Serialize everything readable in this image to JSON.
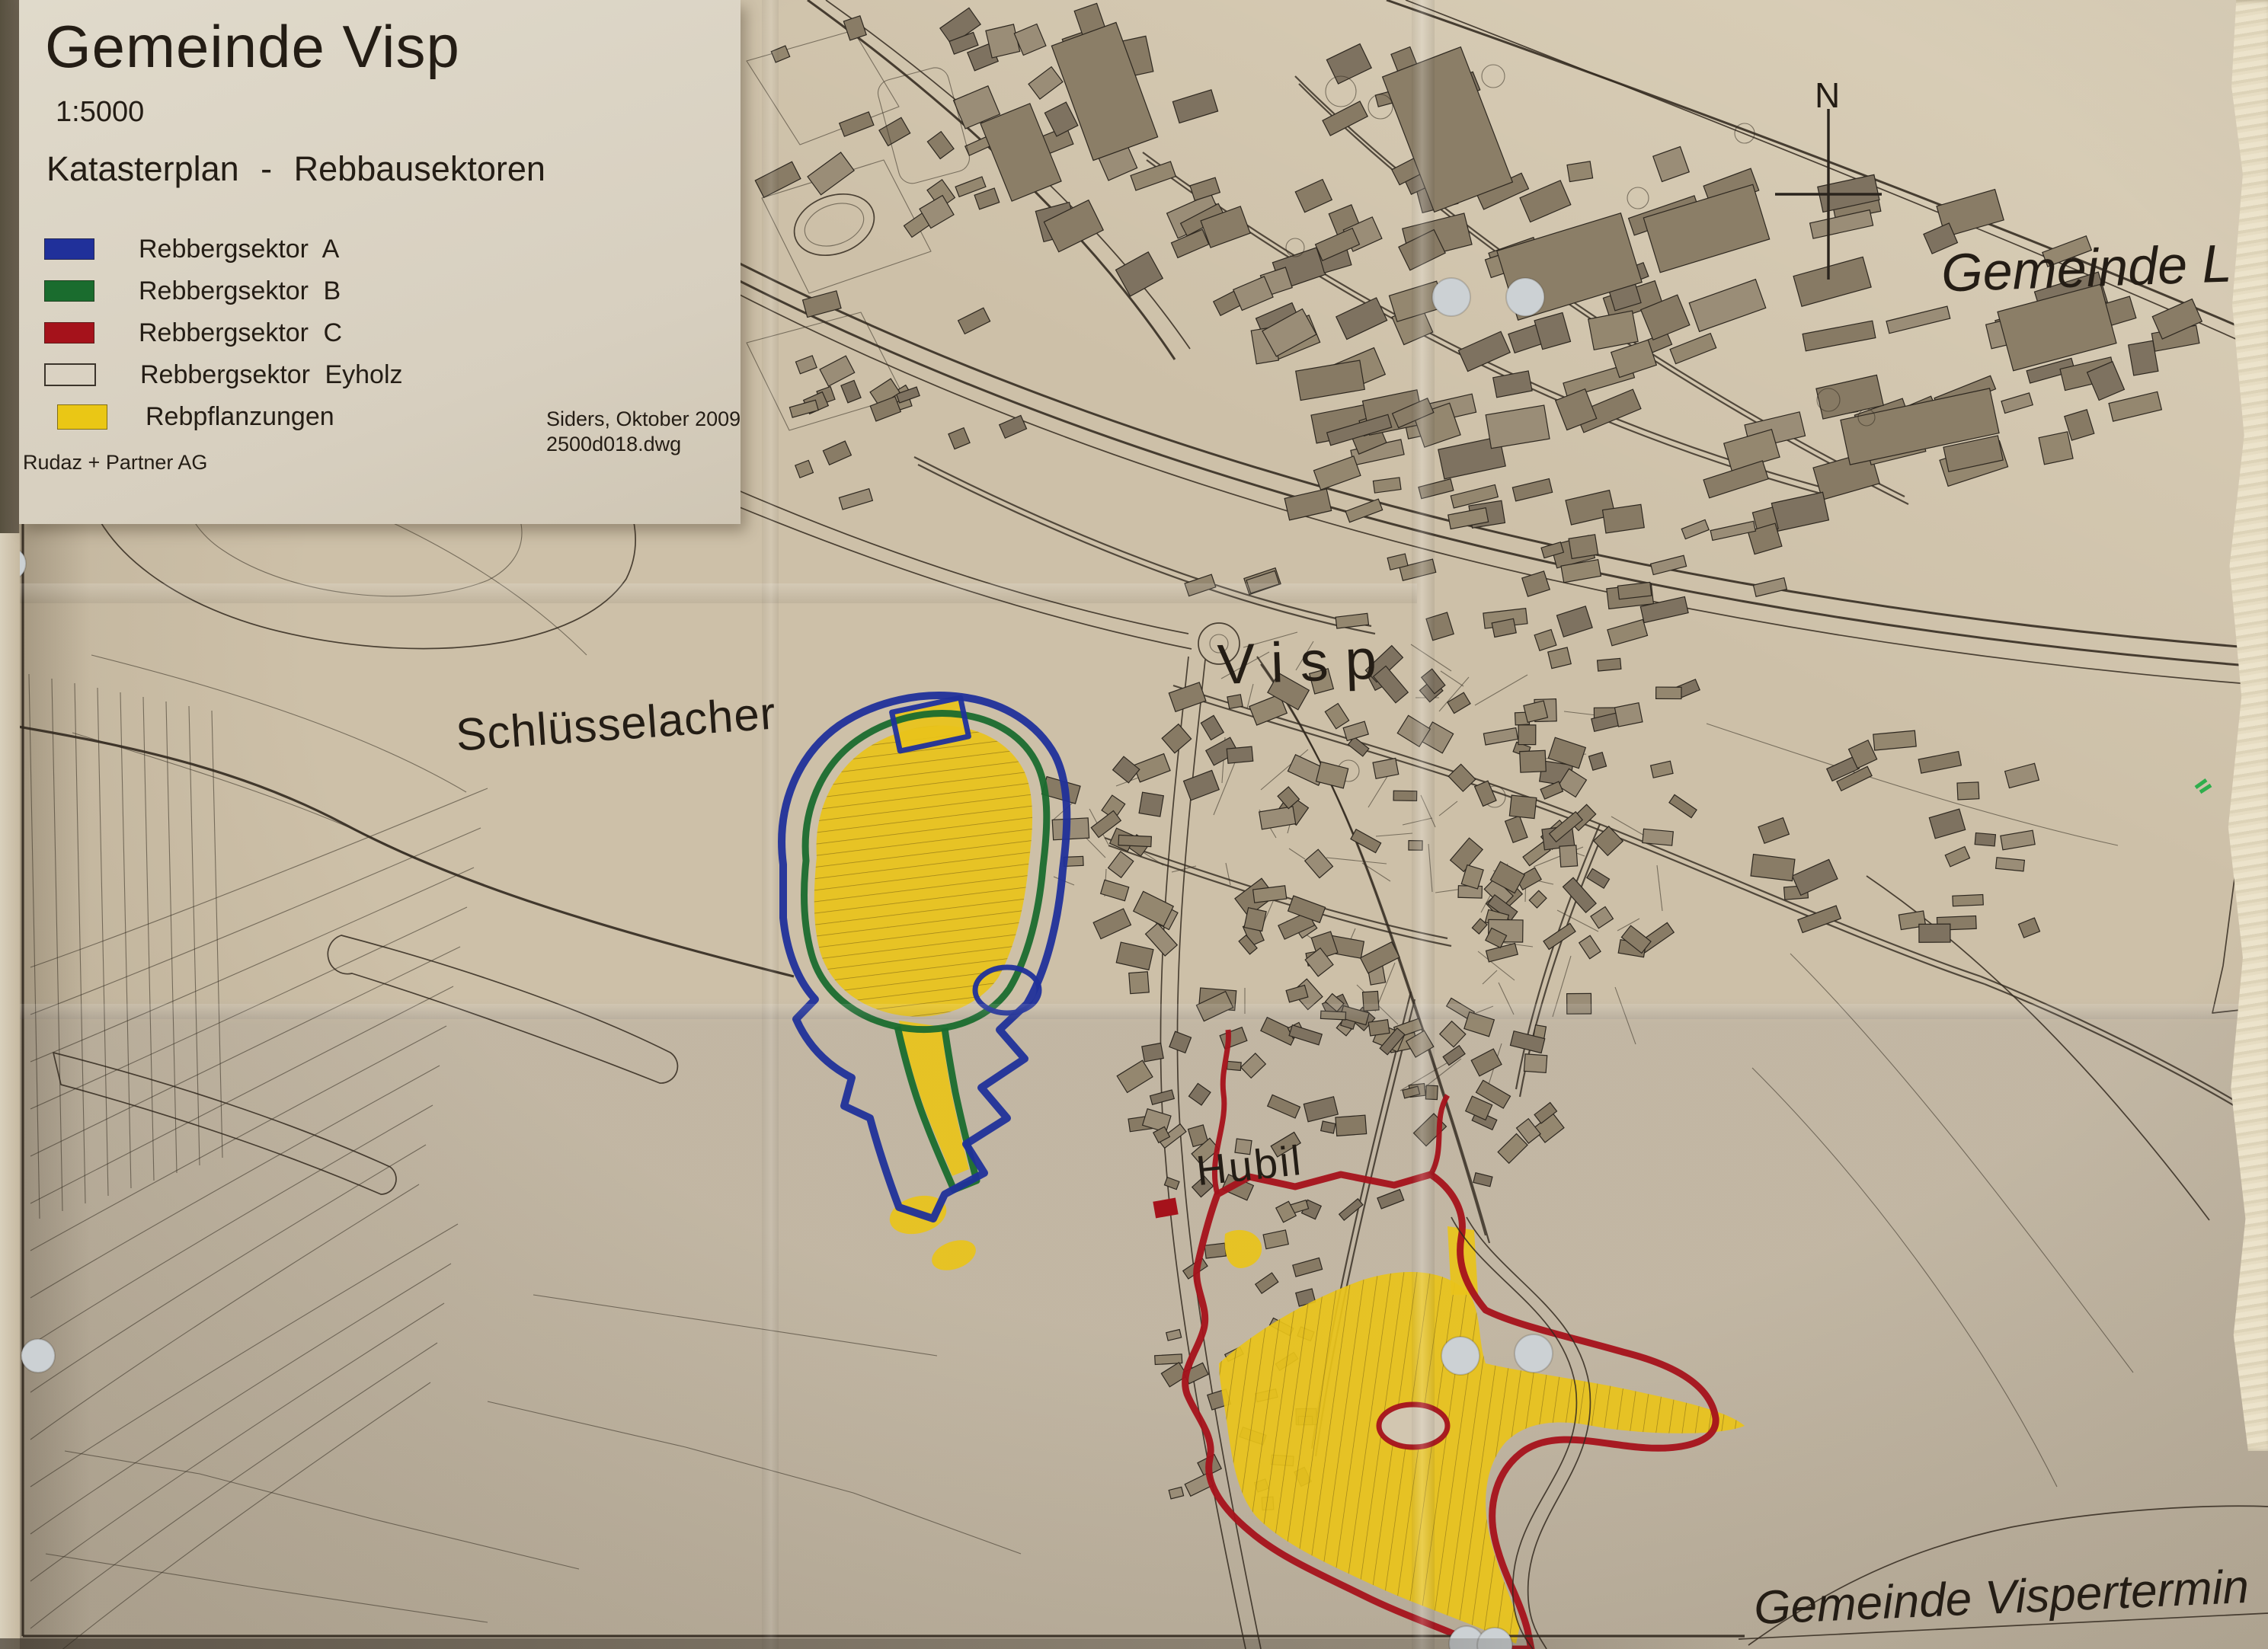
{
  "title_block": {
    "title": "Gemeinde Visp",
    "scale": "1:5000",
    "subtitle": "Katasterplan - Rebbausektoren",
    "legend": [
      {
        "label": "Rebbergsektor A",
        "swatch": "#20309a",
        "style": "filled"
      },
      {
        "label": "Rebbergsektor B",
        "swatch": "#1a6c2e",
        "style": "filled"
      },
      {
        "label": "Rebbergsektor C",
        "swatch": "#a5121b",
        "style": "filled"
      },
      {
        "label": "Rebbergsektor Eyholz",
        "swatch": "#ece5d6",
        "style": "outline"
      },
      {
        "label": "Rebpflanzungen",
        "swatch": "#eac715",
        "style": "filled",
        "indent": true
      }
    ],
    "firm": "Rudaz + Partner AG",
    "note_line1": "Siders, Oktober 2009",
    "note_line2": "2500d018.dwg"
  },
  "map_labels": {
    "city": "Visp",
    "schluesselacher": "Schlüsselacher",
    "hubil": "Hubil",
    "neighbor_right": "Gemeinde L",
    "neighbor_bottom": "Gemeinde Vispertermin",
    "north": "N"
  },
  "colors": {
    "sector_a": "#20309a",
    "sector_b": "#1a6c2e",
    "sector_c": "#a5121b",
    "vineyard": "#e9c31a",
    "ink": "#32291f",
    "building": "#8d8069",
    "paper": "#cdc0a8",
    "title_paper": "#dcd5c6"
  }
}
